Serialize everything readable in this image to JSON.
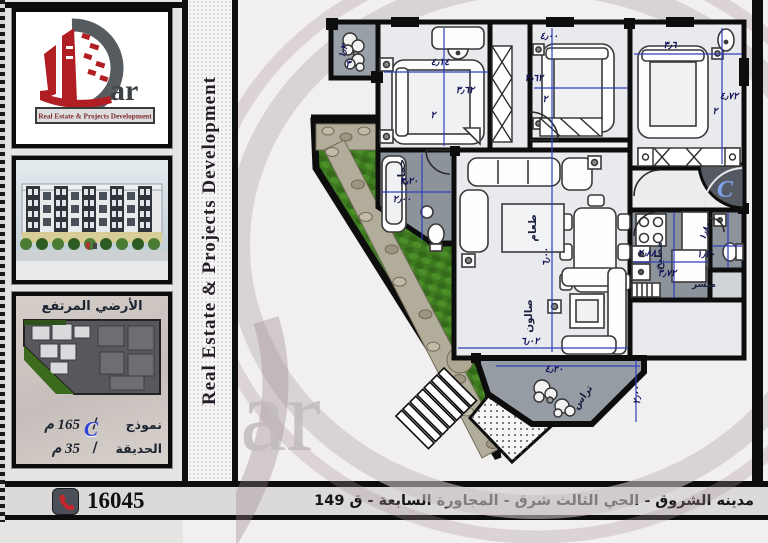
{
  "brand": {
    "logo_latin": "ar",
    "logo_arabic": "دار",
    "logo_tagline": "Real Estate & Projects Development",
    "vertical_banner": "Real Estate & Projects Development",
    "watermark_text": "ar"
  },
  "sidebar": {
    "site_plan": {
      "title": "الأرضي المرتفع",
      "unit_letter": "C",
      "rows": [
        {
          "label": "نموذج",
          "separator": "/",
          "value": "165 م"
        },
        {
          "label": "الحديقة",
          "separator": "/",
          "value": "35 م"
        }
      ]
    }
  },
  "footer": {
    "phone": "16045",
    "address": "مدينه الشروق - الحي الثالث شرق - المجاورة السابعة - ق 149"
  },
  "floor_plan": {
    "unit_letter": "C",
    "labels": [
      {
        "text": "حمام",
        "x": 169,
        "y": 172,
        "rot": -90,
        "cls": "room"
      },
      {
        "text": "طعام",
        "x": 300,
        "y": 228,
        "rot": -90,
        "cls": "room"
      },
      {
        "text": "صالون",
        "x": 296,
        "y": 316,
        "rot": -90,
        "cls": "room"
      },
      {
        "text": "مطبخ",
        "x": 426,
        "y": 256,
        "rot": -90,
        "cls": "room"
      },
      {
        "text": "منشر",
        "x": 468,
        "y": 287,
        "cls": "room",
        "s": 9
      },
      {
        "text": "تراس",
        "x": 349,
        "y": 399,
        "rot": -55,
        "cls": "room",
        "s": 10
      },
      {
        "text": "٤٫١٤",
        "x": 204,
        "y": 65,
        "cls": "dim"
      },
      {
        "text": "٣٫٦٢",
        "x": 229,
        "y": 93,
        "cls": "dim"
      },
      {
        "text": "٢",
        "x": 197,
        "y": 118,
        "cls": "dim"
      },
      {
        "text": "٤٫٠٠",
        "x": 313,
        "y": 39,
        "cls": "dim"
      },
      {
        "text": "٣٫٦٢",
        "x": 298,
        "y": 81,
        "cls": "dim"
      },
      {
        "text": "٢",
        "x": 309,
        "y": 102,
        "cls": "dim"
      },
      {
        "text": "٣٫٦",
        "x": 434,
        "y": 48,
        "cls": "dim"
      },
      {
        "text": "٤٫٧٢",
        "x": 493,
        "y": 99,
        "cls": "dim"
      },
      {
        "text": "٢",
        "x": 479,
        "y": 114,
        "cls": "dim"
      },
      {
        "text": "٣٫٢٠",
        "x": 173,
        "y": 184,
        "cls": "dim"
      },
      {
        "text": "٢٫٠٠",
        "x": 166,
        "y": 202,
        "cls": "dim"
      },
      {
        "text": "٦٫٠٠",
        "x": 313,
        "y": 257,
        "rot": -90,
        "cls": "dim"
      },
      {
        "text": "٦٫٠٢",
        "x": 294,
        "y": 344,
        "cls": "dim"
      },
      {
        "text": "٢٫٨٨",
        "x": 411,
        "y": 256,
        "cls": "dim"
      },
      {
        "text": "٣٫٧٢",
        "x": 431,
        "y": 276,
        "cls": "dim"
      },
      {
        "text": "١٫٨٠",
        "x": 472,
        "y": 232,
        "rot": -70,
        "cls": "dim"
      },
      {
        "text": "١٫٢٠",
        "x": 470,
        "y": 257,
        "cls": "dim"
      },
      {
        "text": "٤٫٢٠",
        "x": 318,
        "y": 372,
        "cls": "dim"
      },
      {
        "text": "٢٫٠٠",
        "x": 404,
        "y": 395,
        "rot": -90,
        "cls": "dim"
      },
      {
        "text": "١٫٢",
        "x": 110,
        "y": 52,
        "rot": -75,
        "cls": "dim"
      },
      {
        "text": "٣",
        "x": 112,
        "y": 67,
        "cls": "dim"
      },
      {
        "text": "C",
        "x": 489,
        "y": 197,
        "cls": "unit"
      }
    ]
  },
  "colors": {
    "logo_red": "#b01e23",
    "swoosh_gray": "#565b60",
    "dimension_blue": "#2f3fbb",
    "unit_blue": "#2e43d6",
    "grass_green": "#3e7a20",
    "phone_red": "#c3272b",
    "wall_black": "#0d0d0d"
  }
}
